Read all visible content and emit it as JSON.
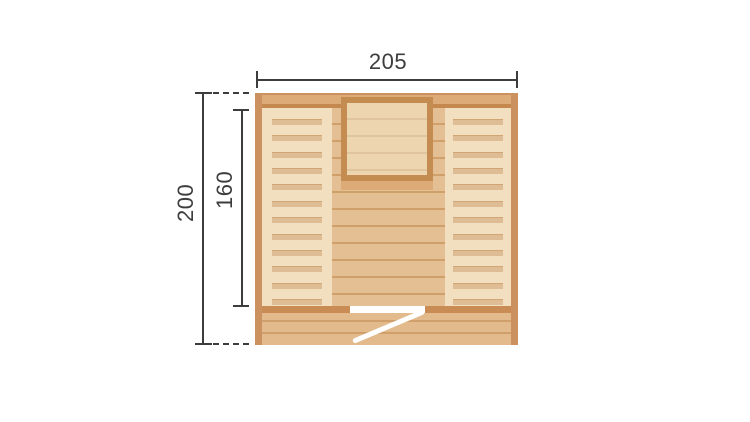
{
  "diagram": {
    "type": "floor-plan dimension drawing",
    "dimensions": {
      "width": {
        "label": "205"
      },
      "depth": {
        "label": "200"
      },
      "bench_length": {
        "label": "160"
      }
    },
    "drawing": {
      "bench_slat_count": 12,
      "bench_slat_first_top": 11,
      "bench_slat_stride": 16.36
    },
    "colors": {
      "background": "#ffffff",
      "dim-line": "#3d3d3d",
      "wall-frame": "#cb9260",
      "wall-band": "#dcab77",
      "wall-stripe": "#c5894f",
      "bench": "#f2dfc0",
      "bench-slat": "#dfbd94",
      "bench-slat-edge": "#cfa674",
      "floor": "#e5bf94",
      "floor-line": "#cfa06a",
      "heater-frame": "#c48c51",
      "heater-fill": "#edd5af",
      "heater-line": "#dfc49e",
      "front-bar": "#c98c55",
      "deck": "#e2ba8c",
      "deck-line": "#cfa06c",
      "door-leaf": "#ffffff"
    }
  }
}
